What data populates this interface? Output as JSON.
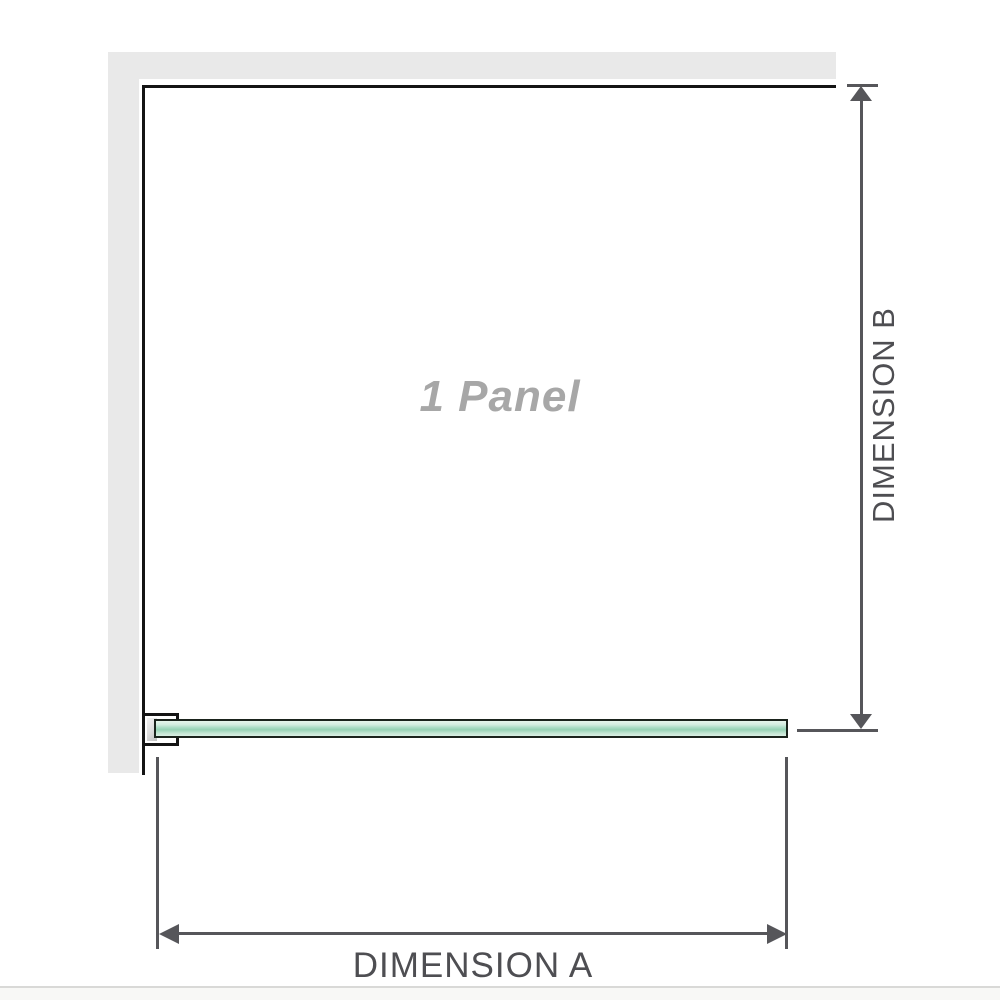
{
  "diagram": {
    "panel_label": "1 Panel",
    "dimension_a": {
      "label": "DIMENSION A"
    },
    "dimension_b": {
      "label": "DIMENSION B"
    }
  },
  "colors": {
    "wall": "#e9e9e9",
    "panel_border": "#141414",
    "dimension": "#56565a",
    "dim_text": "#4e4e52",
    "glass_outline": "#1a231c",
    "glass_light": "#e7f5ec",
    "glass_mid": "#96d2b4",
    "label_gray": "#a7a7a7",
    "rule": "#d9d9d7"
  }
}
